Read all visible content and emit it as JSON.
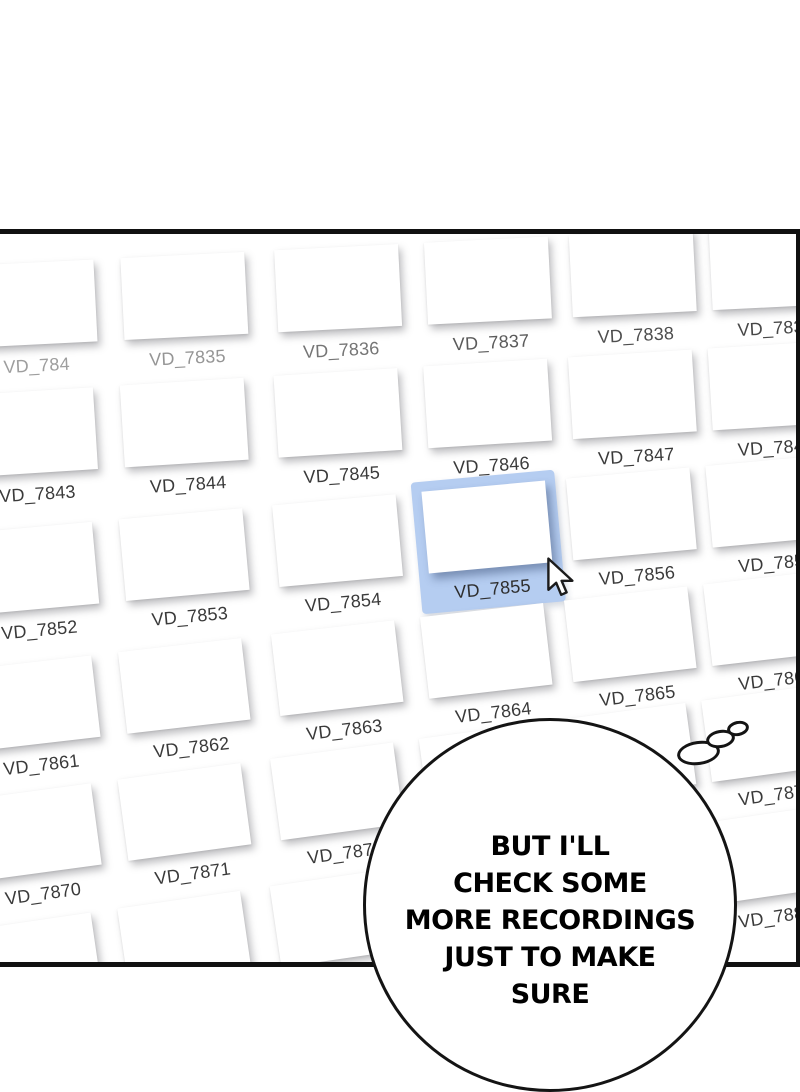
{
  "panel": {
    "border_color": "#111111",
    "background": "#ffffff"
  },
  "grid": {
    "tile_w": 124,
    "tile_h": 82,
    "columns_x": [
      -28,
      123,
      277,
      427,
      572,
      712
    ],
    "label_default_color": "#3a3a3a",
    "rows": [
      {
        "top": 244,
        "angle": -2.9,
        "labels": [
          "VD_784",
          "VD_7835",
          "VD_7836",
          "VD_7837",
          "VD_7838",
          "VD_7839"
        ],
        "label_colors": [
          "#9e9e9e",
          "#959595",
          "#757575",
          "#5a5a5a",
          "#4e4e4e",
          "#474747"
        ]
      },
      {
        "top": 368,
        "angle": -3.6,
        "labels": [
          "VD_7843",
          "VD_7844",
          "VD_7845",
          "VD_7846",
          "VD_7847",
          "VD_7848"
        ]
      },
      {
        "top": 494,
        "angle": -5.2,
        "labels": [
          "VD_7852",
          "VD_7853",
          "VD_7854",
          "VD_7855",
          "VD_7856",
          "VD_7857"
        ],
        "selected_index": 3
      },
      {
        "top": 620,
        "angle": -6.6,
        "labels": [
          "VD_7861",
          "VD_7862",
          "VD_7863",
          "VD_7864",
          "VD_7865",
          "VD_7866"
        ]
      },
      {
        "top": 742,
        "angle": -7.7,
        "labels": [
          "VD_7870",
          "VD_7871",
          "VD_7872",
          null,
          null,
          "VD_7875"
        ]
      },
      {
        "top": 868,
        "angle": -8.3,
        "labels": [
          null,
          null,
          null,
          null,
          null,
          "VD_7884"
        ]
      }
    ]
  },
  "selection": {
    "label": "VD_7855",
    "fill": "#b5cdf1",
    "text_color": "#2e2e2e"
  },
  "cursor": {
    "icon": "arrow-pointer",
    "fill": "#ffffff",
    "outline": "#1b1b1b"
  },
  "thought_bubble": {
    "lines": [
      "BUT I'LL",
      "CHECK SOME",
      "MORE RECORDINGS",
      "JUST TO MAKE",
      "SURE"
    ],
    "text_color": "#000000",
    "outline_color": "#141414"
  }
}
